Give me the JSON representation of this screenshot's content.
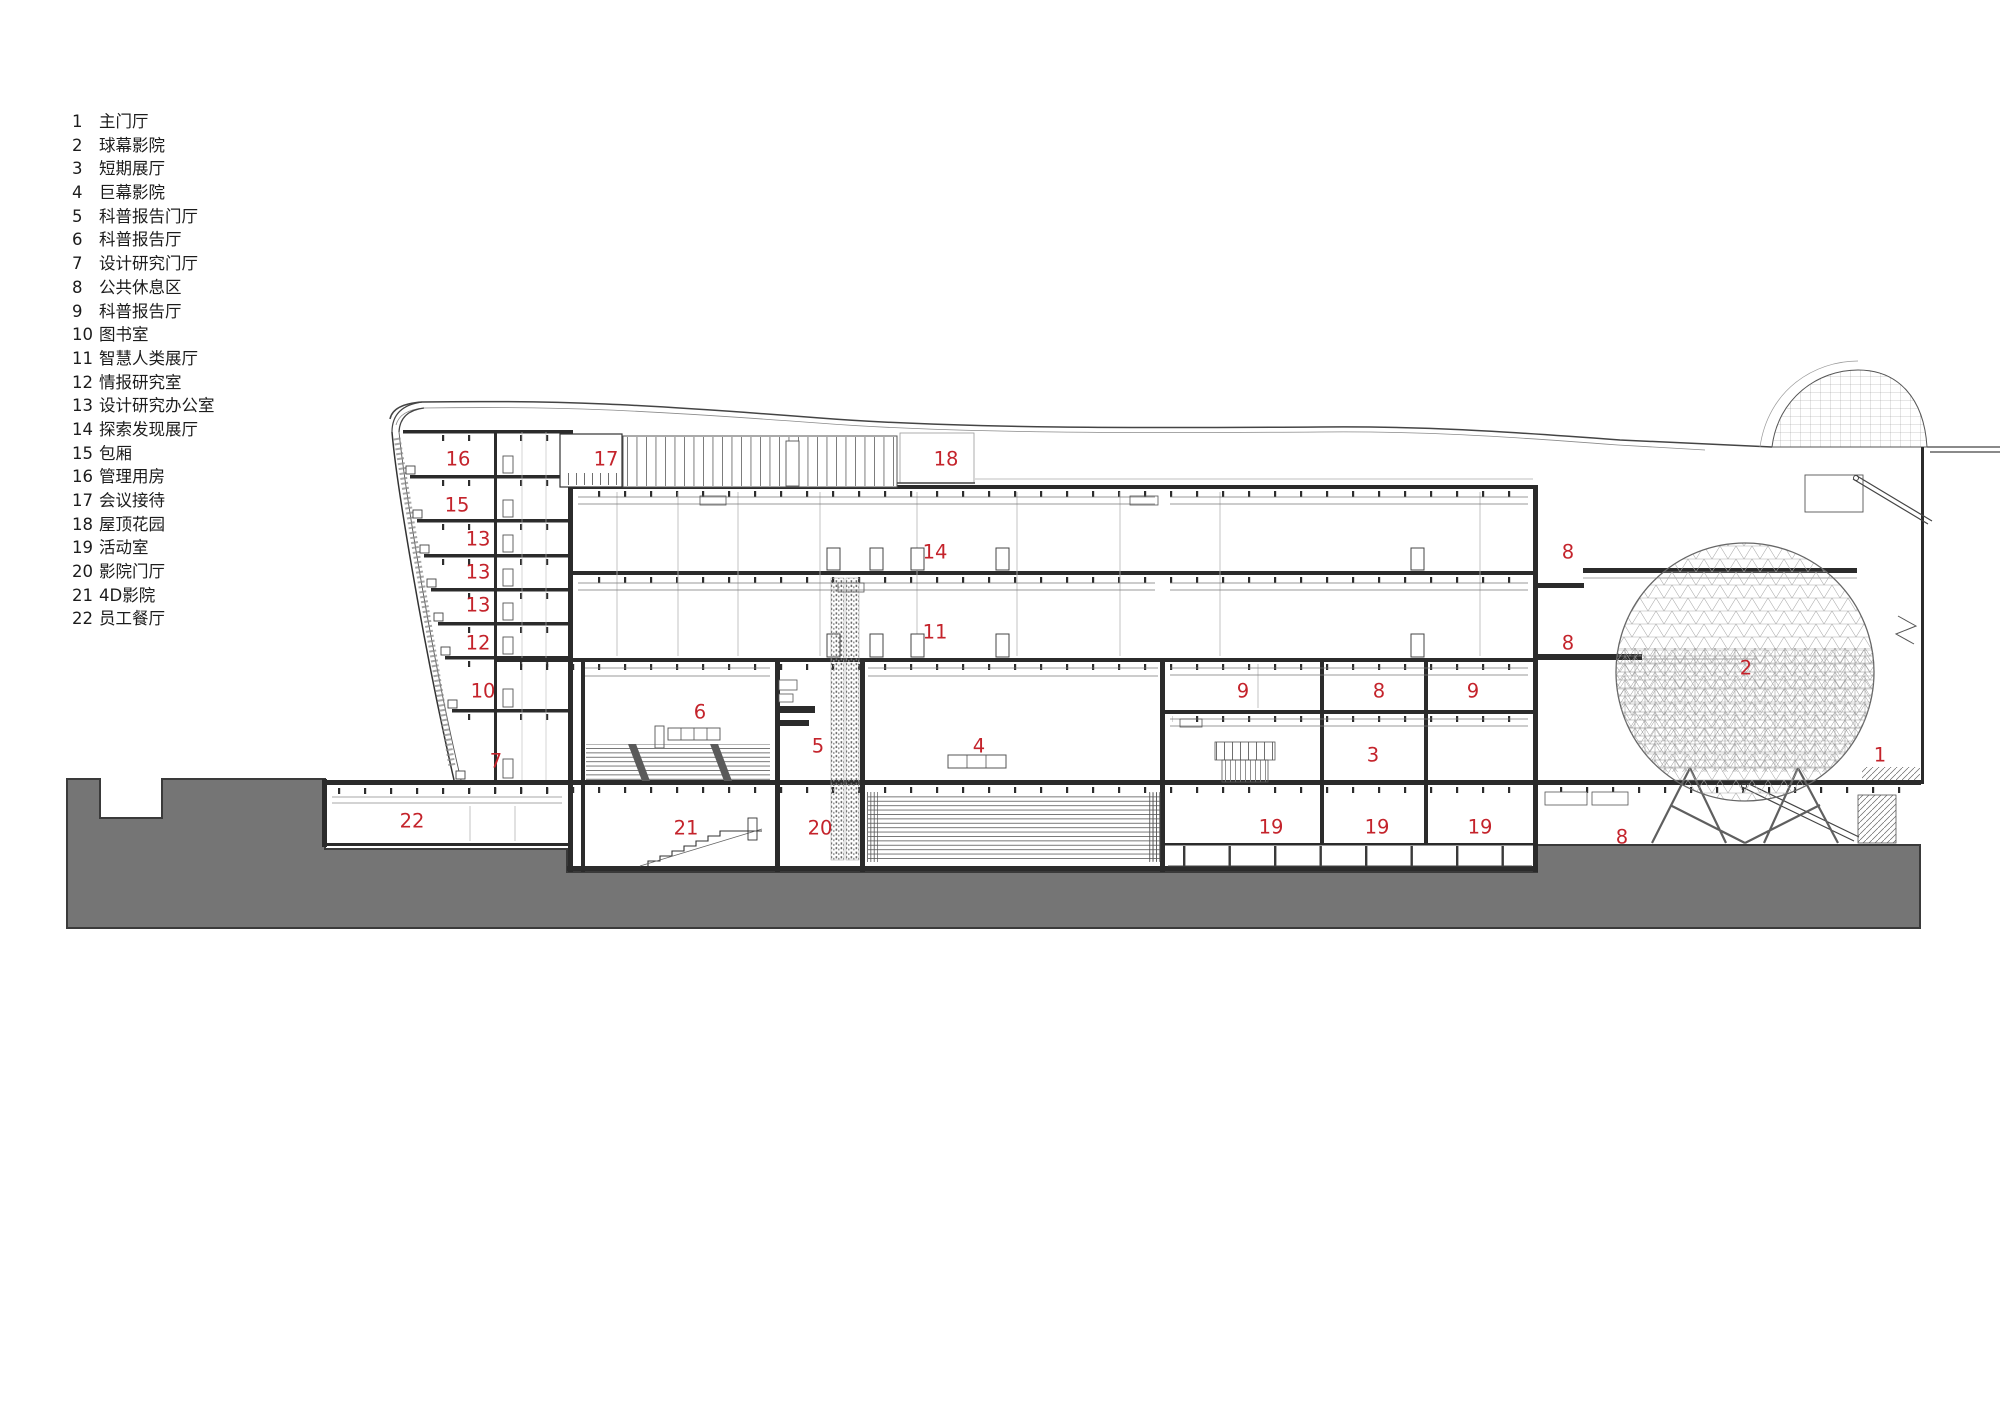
{
  "colors": {
    "accent": "#c4232b",
    "ground": "#757575",
    "ink": "#1c1c1c"
  },
  "legend": {
    "items": [
      {
        "num": "1",
        "label": "主门厅"
      },
      {
        "num": "2",
        "label": "球幕影院"
      },
      {
        "num": "3",
        "label": "短期展厅"
      },
      {
        "num": "4",
        "label": "巨幕影院"
      },
      {
        "num": "5",
        "label": "科普报告门厅"
      },
      {
        "num": "6",
        "label": "科普报告厅"
      },
      {
        "num": "7",
        "label": "设计研究门厅"
      },
      {
        "num": "8",
        "label": "公共休息区"
      },
      {
        "num": "9",
        "label": "科普报告厅"
      },
      {
        "num": "10",
        "label": "图书室"
      },
      {
        "num": "11",
        "label": "智慧人类展厅"
      },
      {
        "num": "12",
        "label": "情报研究室"
      },
      {
        "num": "13",
        "label": "设计研究办公室"
      },
      {
        "num": "14",
        "label": "探索发现展厅"
      },
      {
        "num": "15",
        "label": "包厢"
      },
      {
        "num": "16",
        "label": "管理用房"
      },
      {
        "num": "17",
        "label": "会议接待"
      },
      {
        "num": "18",
        "label": "屋顶花园"
      },
      {
        "num": "19",
        "label": "活动室"
      },
      {
        "num": "20",
        "label": "影院门厅"
      },
      {
        "num": "21",
        "label": "4D影院"
      },
      {
        "num": "22",
        "label": "员工餐厅"
      }
    ]
  },
  "annotations": [
    {
      "n": "16",
      "x": 458,
      "y": 460
    },
    {
      "n": "15",
      "x": 457,
      "y": 506
    },
    {
      "n": "13",
      "x": 478,
      "y": 540
    },
    {
      "n": "13",
      "x": 478,
      "y": 573
    },
    {
      "n": "13",
      "x": 478,
      "y": 606
    },
    {
      "n": "12",
      "x": 478,
      "y": 644
    },
    {
      "n": "10",
      "x": 483,
      "y": 692
    },
    {
      "n": "7",
      "x": 496,
      "y": 762
    },
    {
      "n": "22",
      "x": 412,
      "y": 822
    },
    {
      "n": "17",
      "x": 606,
      "y": 460
    },
    {
      "n": "18",
      "x": 946,
      "y": 460
    },
    {
      "n": "14",
      "x": 935,
      "y": 553
    },
    {
      "n": "11",
      "x": 935,
      "y": 633
    },
    {
      "n": "6",
      "x": 700,
      "y": 713
    },
    {
      "n": "5",
      "x": 818,
      "y": 747
    },
    {
      "n": "4",
      "x": 979,
      "y": 747
    },
    {
      "n": "21",
      "x": 686,
      "y": 829
    },
    {
      "n": "20",
      "x": 820,
      "y": 829
    },
    {
      "n": "9",
      "x": 1243,
      "y": 692
    },
    {
      "n": "8",
      "x": 1379,
      "y": 692
    },
    {
      "n": "9",
      "x": 1473,
      "y": 692
    },
    {
      "n": "3",
      "x": 1373,
      "y": 756
    },
    {
      "n": "19",
      "x": 1271,
      "y": 828
    },
    {
      "n": "19",
      "x": 1377,
      "y": 828
    },
    {
      "n": "19",
      "x": 1480,
      "y": 828
    },
    {
      "n": "8",
      "x": 1568,
      "y": 553
    },
    {
      "n": "8",
      "x": 1568,
      "y": 644
    },
    {
      "n": "8",
      "x": 1622,
      "y": 838
    },
    {
      "n": "2",
      "x": 1746,
      "y": 669
    },
    {
      "n": "1",
      "x": 1880,
      "y": 756
    }
  ]
}
